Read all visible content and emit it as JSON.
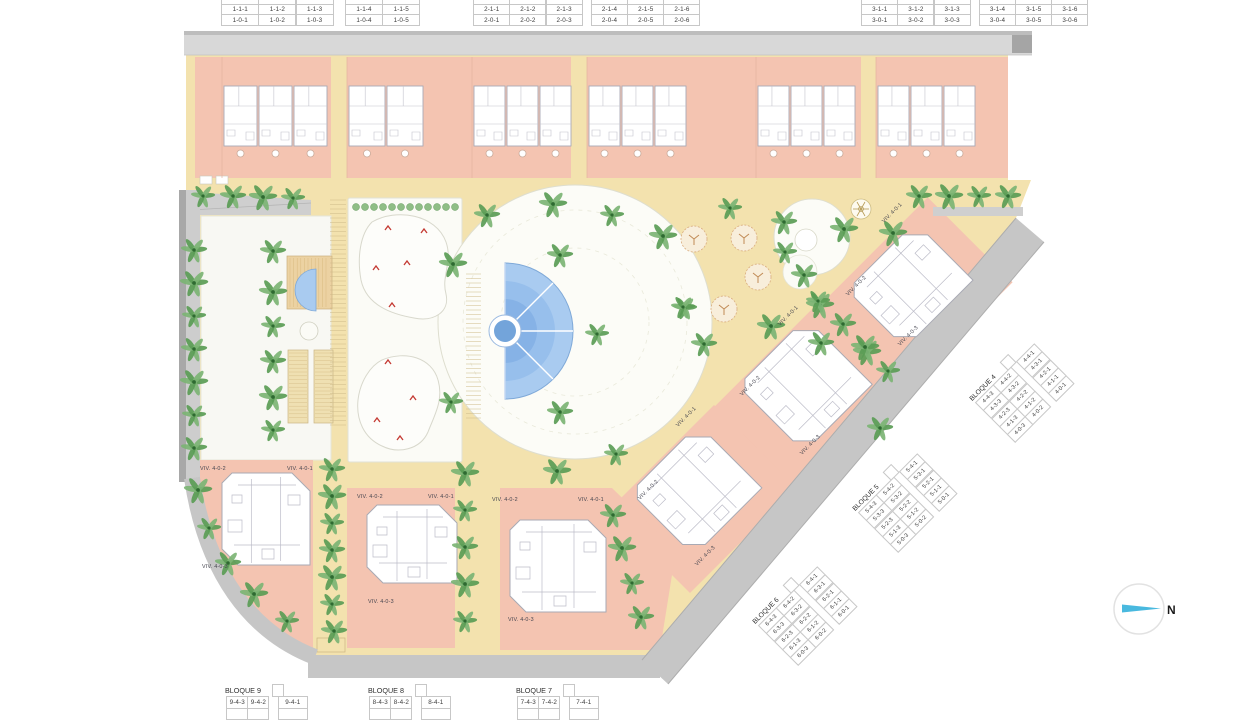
{
  "north": {
    "label": "N"
  },
  "colors": {
    "path_cream": "#f3e2ae",
    "building_salmon": "#f4c4b1",
    "plan_white": "#ffffff",
    "pool_blue": "#a9cbf0",
    "pool_deep": "#73a4da",
    "tree_green": "#5a9c55",
    "road_gray": "#c9c9c9",
    "red_mark": "#c43a33",
    "north_arrow_blue": "#49b9df",
    "table_border": "#c7c7c7",
    "table_text": "#3c3c3c"
  },
  "viv_labels": [
    "VIV. 4-0-1",
    "VIV. 4-0-2",
    "VIV. 4-0-3"
  ],
  "top_tables": [
    {
      "clipped_row": [
        "1-2-1",
        "1-2-2",
        "1-2-3",
        "1-2-4",
        "1-2-5"
      ],
      "rows": [
        [
          "1-1-1",
          "1-1-2",
          "1-1-3",
          "1-1-4",
          "1-1-5"
        ],
        [
          "1-0-1",
          "1-0-2",
          "1-0-3",
          "1-0-4",
          "1-0-5"
        ]
      ],
      "gap_after": 3
    },
    {
      "clipped_row": [
        "2-2-1",
        "2-2-2",
        "2-2-3",
        "2-2-4",
        "2-2-5",
        "2-2-6"
      ],
      "rows": [
        [
          "2-1-1",
          "2-1-2",
          "2-1-3",
          "2-1-4",
          "2-1-5",
          "2-1-6"
        ],
        [
          "2-0-1",
          "2-0-2",
          "2-0-3",
          "2-0-4",
          "2-0-5",
          "2-0-6"
        ]
      ],
      "gap_after": 3
    },
    {
      "clipped_row": [
        "3-2-1",
        "3-2-2",
        "3-2-3",
        "3-2-4",
        "3-2-5",
        "3-2-6"
      ],
      "rows": [
        [
          "3-1-1",
          "3-1-2",
          "3-1-3",
          "3-1-4",
          "3-1-5",
          "3-1-6"
        ],
        [
          "3-0-1",
          "3-0-2",
          "3-0-3",
          "3-0-4",
          "3-0-5",
          "3-0-6"
        ]
      ],
      "gap_after": 3
    }
  ],
  "rotated_tables": [
    {
      "title": "BLOQUE 4",
      "rows": [
        [
          "4-4-3",
          "4-4-2",
          "4-4-1"
        ],
        [
          "4-3-3",
          "4-3-2",
          "4-3-1"
        ],
        [
          "4-2-3",
          "4-2-2",
          "4-2-1"
        ],
        [
          "4-1-3",
          "4-1-2",
          "4-1-1"
        ],
        [
          "4-0-3",
          "4-0-2",
          "4-0-1"
        ]
      ],
      "gap_after": 2
    },
    {
      "title": "BLOQUE 5",
      "rows": [
        [
          "5-4-3",
          "5-4-2",
          "5-4-1"
        ],
        [
          "5-3-3",
          "5-3-2",
          "5-3-1"
        ],
        [
          "5-2-3",
          "5-2-2",
          "5-2-1"
        ],
        [
          "5-1-3",
          "5-1-2",
          "5-1-1"
        ],
        [
          "5-0-3",
          "5-0-2",
          "5-0-1"
        ]
      ],
      "gap_after": 2
    },
    {
      "title": "BLOQUE 6",
      "rows": [
        [
          "6-4-3",
          "6-4-2",
          "6-4-1"
        ],
        [
          "6-3-3",
          "6-3-2",
          "6-3-1"
        ],
        [
          "6-2-3",
          "6-2-2",
          "6-2-1"
        ],
        [
          "6-1-3",
          "6-1-2",
          "6-1-1"
        ],
        [
          "6-0-3",
          "6-0-2",
          "6-0-1"
        ]
      ],
      "gap_after": 2
    }
  ],
  "bottom_tables": [
    {
      "title": "BLOQUE 9",
      "rows": [
        [
          "9-4-3",
          "9-4-2",
          "9-4-1"
        ]
      ],
      "gap_after": 2
    },
    {
      "title": "BLOQUE 8",
      "rows": [
        [
          "8-4-3",
          "8-4-2",
          "8-4-1"
        ]
      ],
      "gap_after": 2
    },
    {
      "title": "BLOQUE 7",
      "rows": [
        [
          "7-4-3",
          "7-4-2",
          "7-4-1"
        ]
      ],
      "gap_after": 2
    }
  ]
}
